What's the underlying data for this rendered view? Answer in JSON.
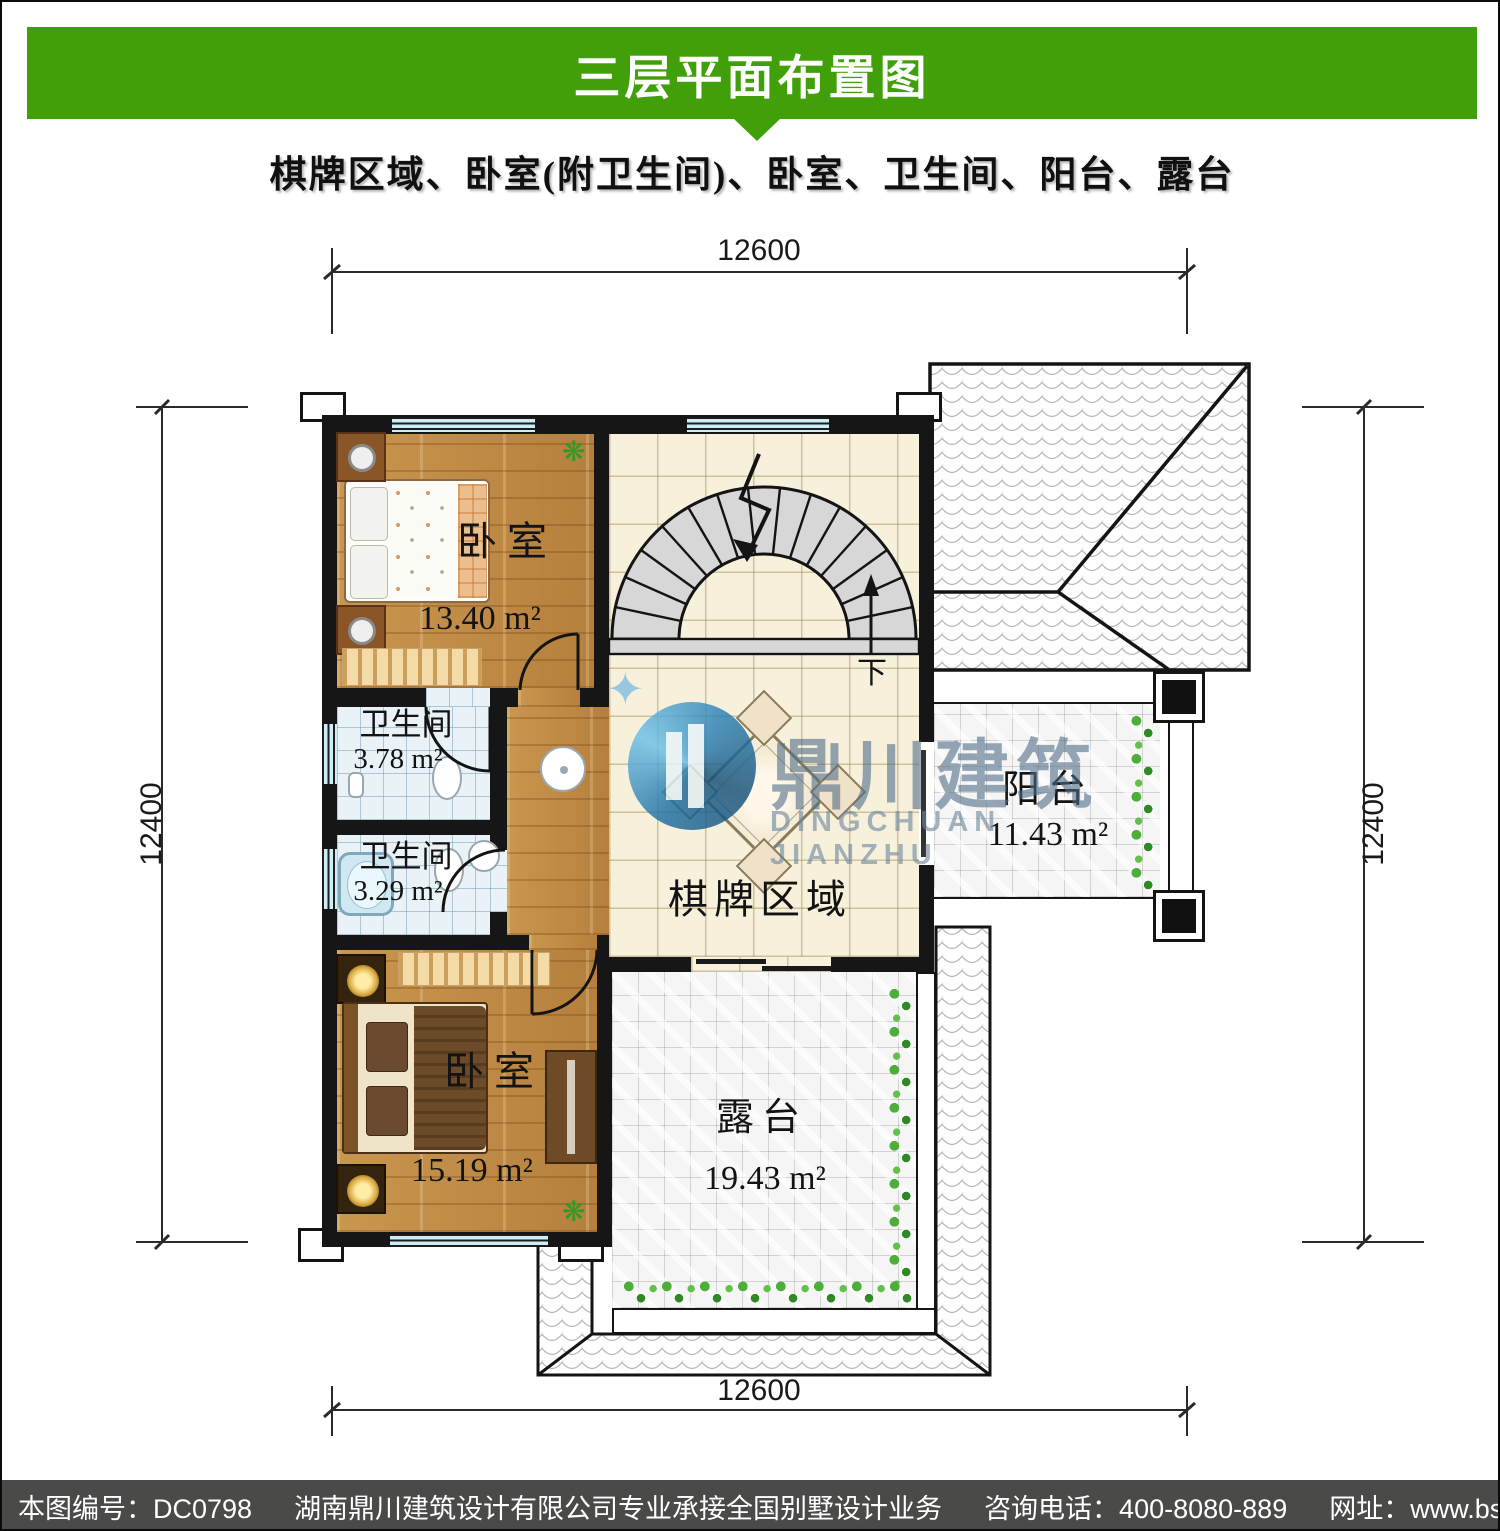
{
  "header": {
    "title": "三层平面布置图"
  },
  "subtitle": "棋牌区域、卧室(附卫生间)、卧室、卫生间、阳台、露台",
  "dimensions": {
    "top": "12600",
    "bottom": "12600",
    "left": "12400",
    "right": "12400"
  },
  "rooms": {
    "bedroom_top": {
      "name": "卧室",
      "area": "13.40 m²"
    },
    "bath_top": {
      "name": "卫生间",
      "area": "3.78 m²"
    },
    "bath_bottom": {
      "name": "卫生间",
      "area": "3.29 m²"
    },
    "bedroom_bottom": {
      "name": "卧室",
      "area": "15.19 m²"
    },
    "chess": {
      "name": "棋牌区域"
    },
    "balcony": {
      "name": "阳台",
      "area": "11.43 m²"
    },
    "terrace": {
      "name": "露台",
      "area": "19.43 m²"
    }
  },
  "stairs": {
    "down_label": "下"
  },
  "watermark": {
    "name_cn": "鼎川建筑",
    "name_en": "DINGCHUAN JIANZHU",
    "star": "✦"
  },
  "decor": {
    "plant_glyph": "❋"
  },
  "footer": {
    "drawing_no": "本图编号：DC0798",
    "company": "湖南鼎川建筑设计有限公司专业承接全国别墅设计业务",
    "phone": "咨询电话：400-8080-889",
    "website": "网址：www.bstzcs.com"
  },
  "colors": {
    "header_green": "#41a009",
    "footer_gray": "#4a4a48",
    "wall": "#161616",
    "watermark_blue": "#50788a"
  }
}
